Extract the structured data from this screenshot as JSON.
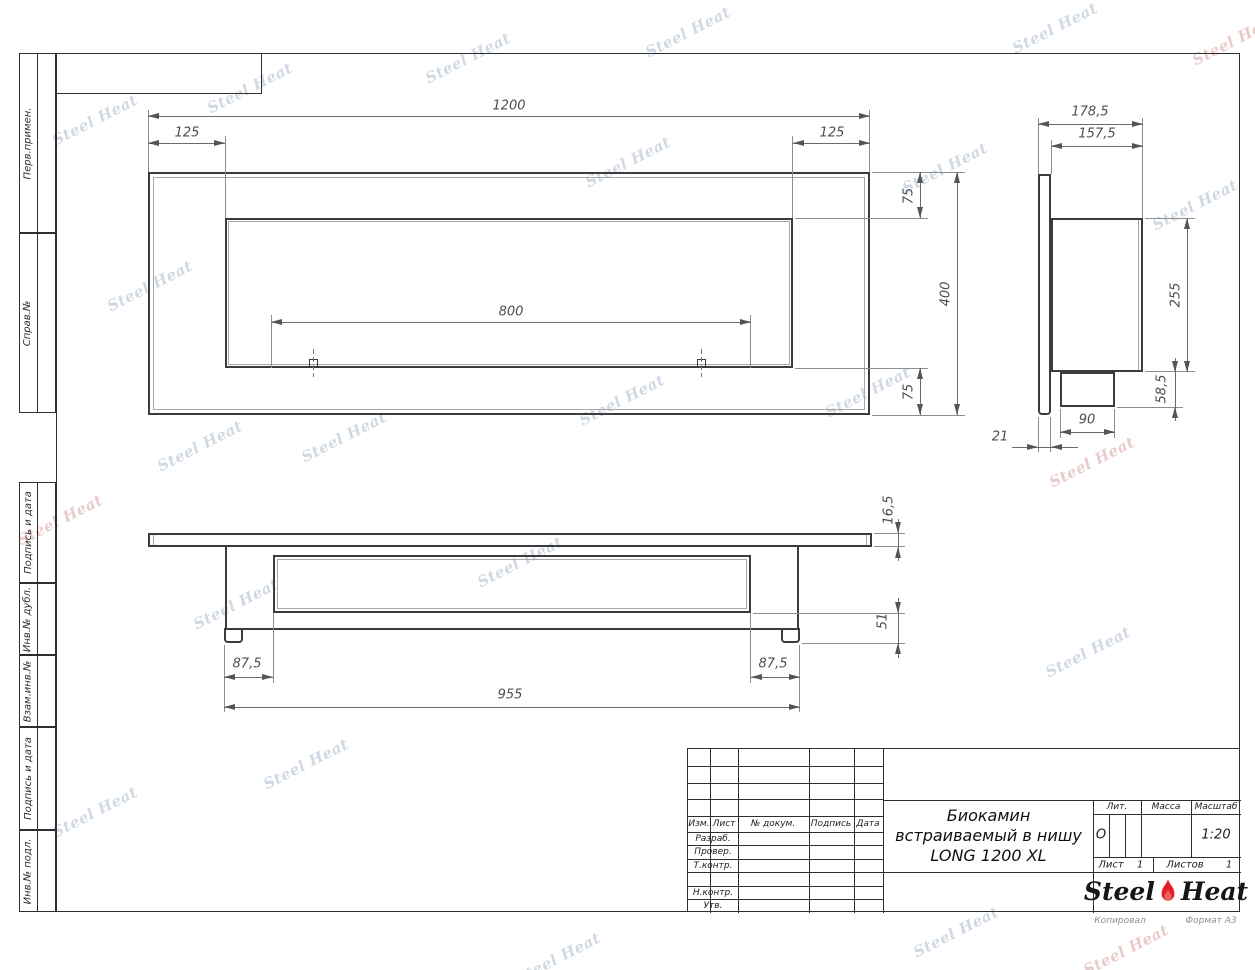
{
  "sheet": {
    "copied_label": "Копировал",
    "format_label": "Формат А3"
  },
  "watermark": {
    "text": "Steel Heat"
  },
  "margin_labels": {
    "perv": "Перв.примен.",
    "sprav": "Справ.№",
    "podpis1": "Подпись и дата",
    "inv_dubl": "Инв.№ дубл.",
    "vzam": "Взам.инв.№",
    "podpis2": "Подпись и дата",
    "inv_podl": "Инв.№ подл."
  },
  "title_block": {
    "header": {
      "izm": "Изм.",
      "list": "Лист",
      "doc": "№ докум.",
      "sign": "Подпись",
      "date": "Дата"
    },
    "rows": {
      "razrab": "Разраб.",
      "prover": "Провер.",
      "tkontr": "Т.контр.",
      "nkontr": "Н.контр.",
      "utv": "Утв."
    },
    "title_line1": "Биокамин",
    "title_line2": "встраиваемый в нишу",
    "title_line3": "LONG 1200 XL",
    "lit_label": "Лит.",
    "lit_value": "О",
    "massa_label": "Масса",
    "masshtab_label": "Масштаб",
    "masshtab_value": "1:20",
    "list_label": "Лист",
    "list_value": "1",
    "listov_label": "Листов",
    "listov_value": "1"
  },
  "logo": {
    "steel": "Steel",
    "heat": "Heat",
    "flame_color": "#e31e24"
  },
  "front_view": {
    "dims": {
      "overall_width": "1200",
      "left_margin": "125",
      "right_margin": "125",
      "opening_width": "800",
      "top_margin": "75",
      "overall_height": "400",
      "bottom_margin": "75"
    }
  },
  "side_view": {
    "dims": {
      "overall_depth": "178,5",
      "body_depth": "157,5",
      "body_height": "255",
      "spout_height": "58,5",
      "spout_width": "90",
      "flange_thickness": "21"
    }
  },
  "bottom_view": {
    "dims": {
      "flange_thickness": "16,5",
      "body_height": "51",
      "left_offset": "87,5",
      "right_offset": "87,5",
      "body_width": "955"
    }
  }
}
